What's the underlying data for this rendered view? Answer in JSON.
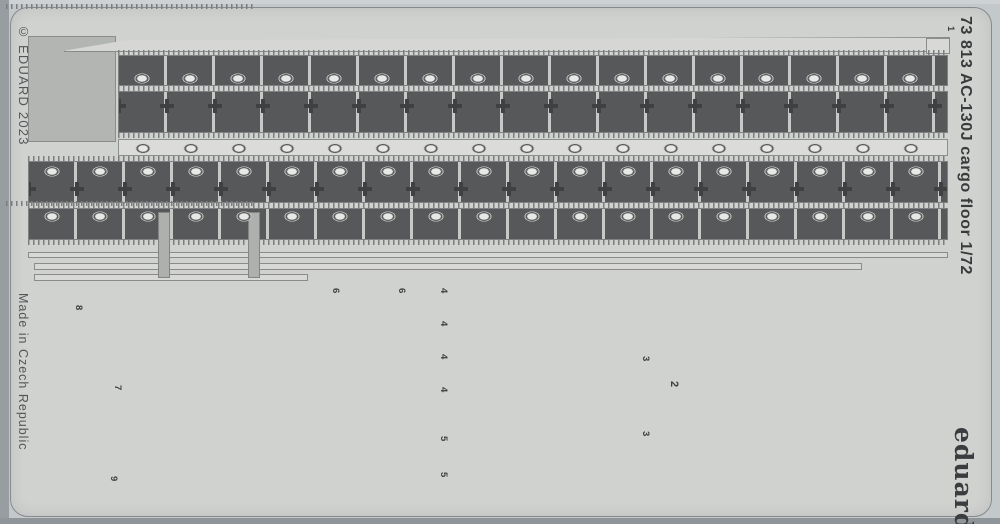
{
  "texts": {
    "copyright": "© EDUARD 2023",
    "made_in": "Made in Czech Republic",
    "product": "73 813  AC-130J cargo floor  1/72",
    "brand": "eduard"
  },
  "labels": [
    {
      "text": "1"
    },
    {
      "text": "8"
    },
    {
      "text": "7"
    },
    {
      "text": "9"
    },
    {
      "text": "6"
    },
    {
      "text": "6"
    },
    {
      "text": "4"
    },
    {
      "text": "4"
    },
    {
      "text": "4"
    },
    {
      "text": "4"
    },
    {
      "text": "5"
    },
    {
      "text": "5"
    },
    {
      "text": "3"
    },
    {
      "text": "3"
    },
    {
      "text": "2"
    }
  ],
  "palette": {
    "background": "#c3c8ca",
    "fret_sheet": "#d0d2d0",
    "etched_dark": "#56585a",
    "waste_grey": "#a4a6a4",
    "part_light": "#d8d9d7",
    "marking_yellow": "#f0d41a",
    "text_grey": "#54565a",
    "brand_dark": "#3a3c3f"
  }
}
